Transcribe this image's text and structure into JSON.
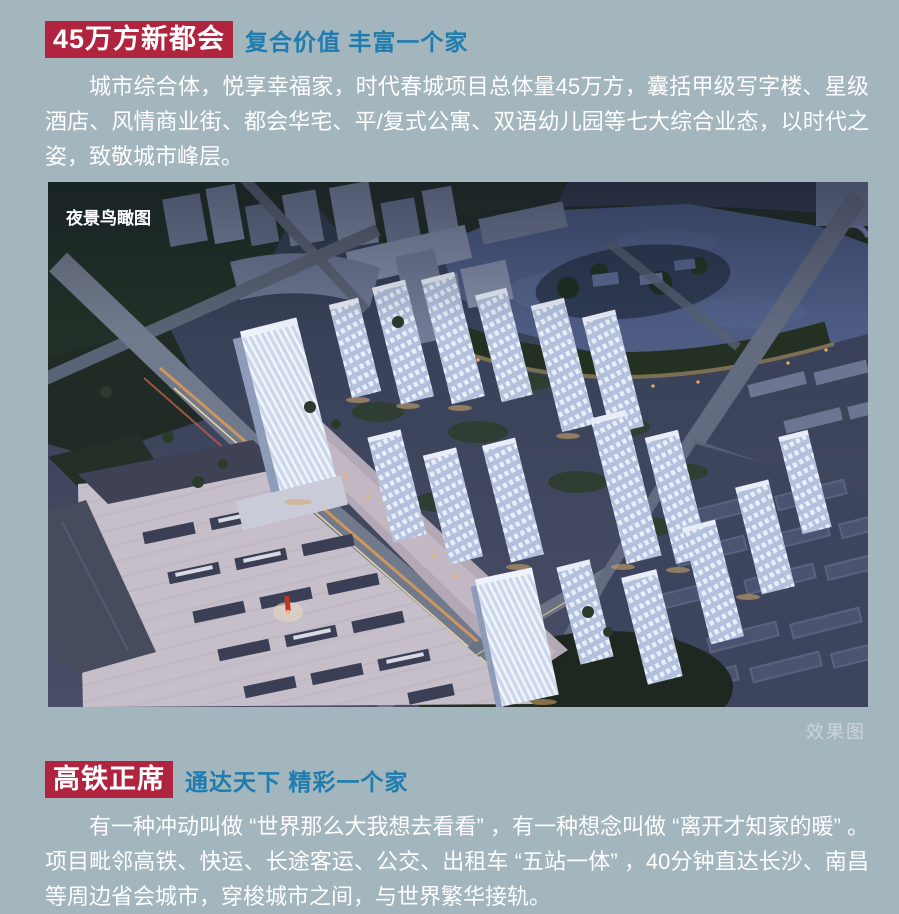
{
  "colors": {
    "page_background": "#a3b5bd",
    "heading_badge_background": "#b12440",
    "heading_text": "#ffffff",
    "subheading_text": "#1e7cae",
    "body_text": "#ffffff",
    "caption_text": "#ccd6da"
  },
  "section1": {
    "heading": "45万方新都会",
    "subheading": "复合价值 丰富一个家",
    "paragraph": "城市综合体，悦享幸福家，时代春城项目总体量45万方，囊括甲级写字楼、星级酒店、风情商业街、都会华宅、平/复式公寓、双语幼儿园等七大综合业态，以时代之姿，致敬城市峰层。"
  },
  "render": {
    "label": "夜景鸟瞰图",
    "caption": "效果图",
    "description": "night aerial rendering of the project"
  },
  "section2": {
    "heading": "高铁正席",
    "subheading": "通达天下 精彩一个家",
    "paragraph": "有一种冲动叫做 “世界那么大我想去看看” ，有一种想念叫做 “离开才知家的暖” 。项目毗邻高铁、快运、长途客运、公交、出租车 “五站一体” ，40分钟直达长沙、南昌等周边省会城市，穿梭城市之间，与世界繁华接轨。"
  }
}
